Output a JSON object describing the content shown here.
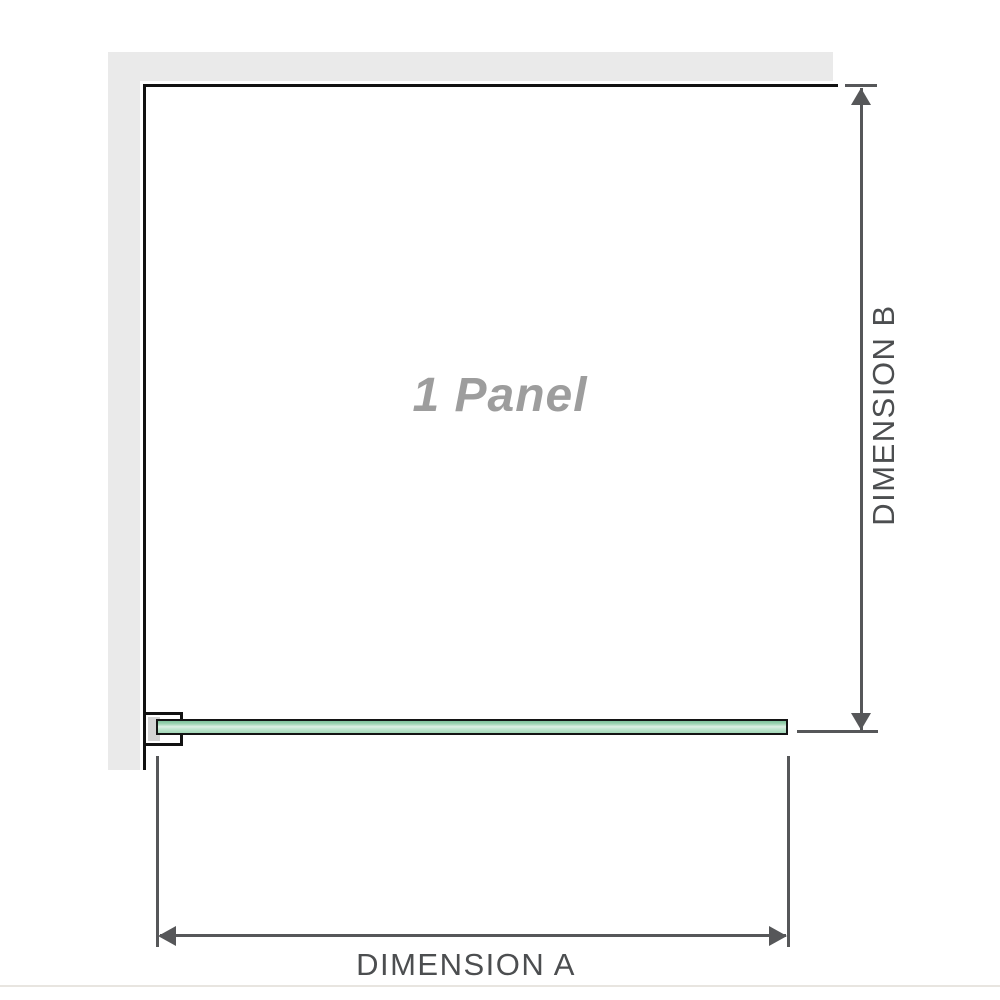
{
  "diagram": {
    "panel_label": "1 Panel",
    "dimension_a_label": "DIMENSION A",
    "dimension_b_label": "DIMENSION B"
  },
  "colors": {
    "background": "#ffffff",
    "wall_fill": "#eaeaea",
    "panel_outline": "#121212",
    "glass_outline": "#141414",
    "glass_green_dark": "#7fc29b",
    "glass_green_light": "#def0e4",
    "bracket_fill": "#ffffff",
    "bracket_inner_shadow": "#d3d3d3",
    "dimension_line": "#565759",
    "dimension_text": "#4c4e50",
    "watermark_text": "#9d9d9d",
    "bottom_rule": "#e8e5e0"
  }
}
